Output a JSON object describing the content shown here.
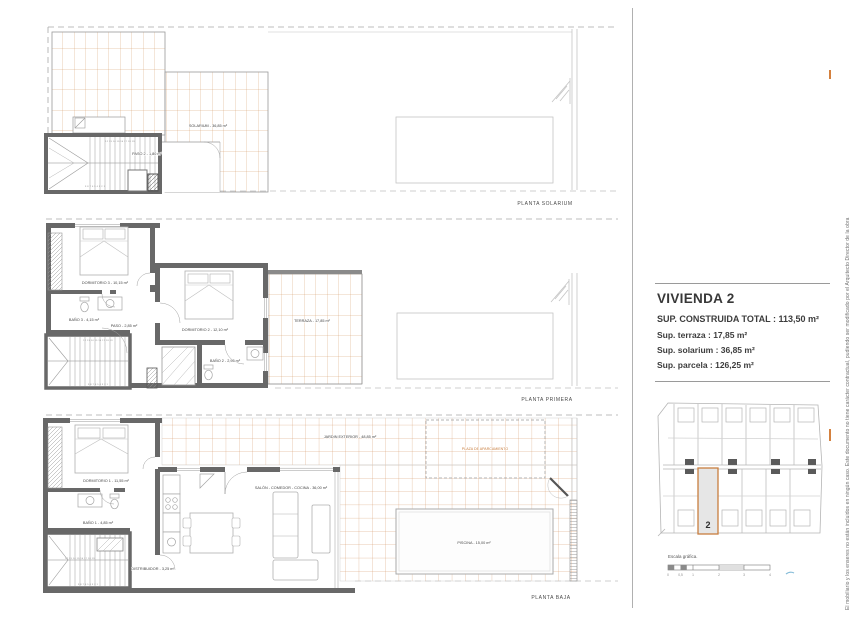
{
  "document": {
    "plans": [
      {
        "title": "PLANTA SOLARIUM",
        "rooms": [
          {
            "label": "SOLARIUM - 36,85 m²"
          },
          {
            "label": "PASO 2 - 1,80 m²"
          }
        ],
        "stairs_top": "12 13 14 15 16 17 18 19",
        "stairs_bottom": "9 8 7 6 5 4 3 2 1"
      },
      {
        "title": "PLANTA PRIMERA",
        "rooms": [
          {
            "label": "DORMITORIO 3 - 10,15 m²"
          },
          {
            "label": "BAÑO 3 - 4,15 m²"
          },
          {
            "label": "PASO - 2,85 m²"
          },
          {
            "label": "DORMITORIO 2 - 12,10 m²"
          },
          {
            "label": "BAÑO 2 - 2,95 m²"
          },
          {
            "label": "TERRAZA - 17,85 m²"
          }
        ],
        "stairs_top": "12 13 14 15 16 17 18 19",
        "stairs_bottom": "9 8 7 6 5 4 3 2 1"
      },
      {
        "title": "PLANTA BAJA",
        "rooms": [
          {
            "label": "DORMITORIO 1 - 11,55 m²"
          },
          {
            "label": "BAÑO 1 - 4,85 m²"
          },
          {
            "label": "DISTRIBUIDOR - 3,25 m²"
          },
          {
            "label": "SALÓN - COMEDOR - COCINA - 36,00 m²"
          },
          {
            "label": "JARDIN EXTERIOR - 48,85 m²"
          },
          {
            "label": "PLAZA DE APARCAMIENTO"
          },
          {
            "label": "PISCINA - 15,00 m²"
          }
        ],
        "stairs_top": "12 13 14 15 16 17 18 19",
        "stairs_bottom": "9 8 7 6 5 4 3 2 1"
      }
    ],
    "info_panel": {
      "title": "VIVIENDA 2",
      "lines": [
        "SUP. CONSTRUIDA TOTAL : 113,50 m²",
        "Sup. terraza : 17,85 m²",
        "Sup. solarium : 36,85 m²",
        "Sup. parcela : 126,25 m²"
      ]
    },
    "site_map": {
      "unit_number": "2",
      "scale_label": "Escala gráfica.",
      "scale_ticks": [
        "0",
        "0,5",
        "1",
        "2",
        "3",
        "4"
      ]
    },
    "disclaimer": "El mobiliario y los enseres no están incluidos en ningún caso. Este documento no tiene carácter contractual, pudiendo ser modificado por el Arquitecto Director de la obra",
    "colors": {
      "wall": "#686868",
      "tile": "#cf8c55",
      "context": "#c4c4c4",
      "highlight": "#c87e3f"
    }
  }
}
